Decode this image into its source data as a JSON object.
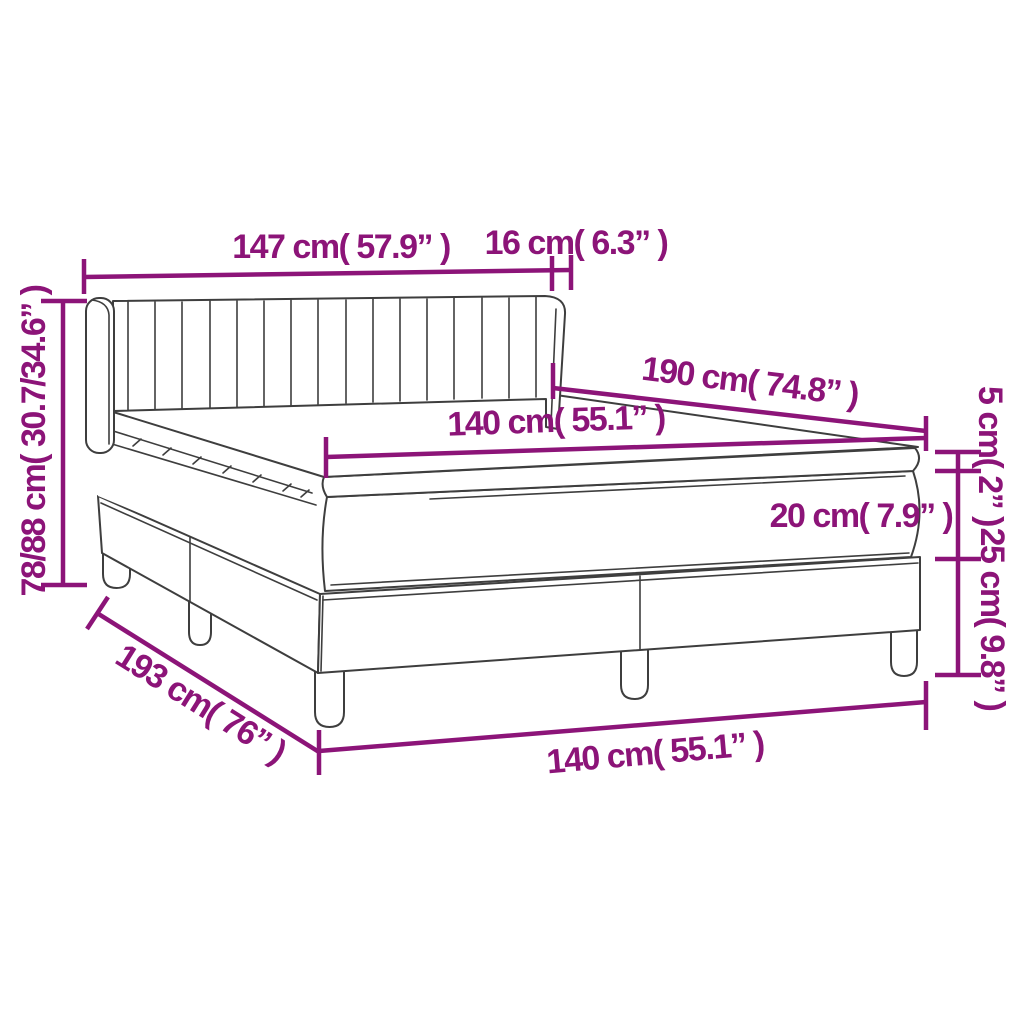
{
  "diagram": {
    "type": "product-dimension-diagram",
    "subject": "box spring bed with headboard, topper, mattress and base on legs",
    "colors": {
      "accent": "#8C1478",
      "outline": "#3E3E3E",
      "background": "#FFFFFF"
    },
    "labels": {
      "headboard_width": "147 cm( 57.9” )",
      "headboard_depth": "16 cm( 6.3” )",
      "total_height": "78/88 cm( 30.7/34.6” )",
      "mattress_length": "190 cm( 74.8” )",
      "mattress_width_top": "140 cm( 55.1” )",
      "topper_height": "5 cm( 2” )",
      "mattress_height": "20 cm( 7.9” )",
      "base_height": "25 cm( 9.8” )",
      "total_length": "193 cm( 76” )",
      "bed_width_bottom": "140 cm( 55.1” )"
    }
  }
}
